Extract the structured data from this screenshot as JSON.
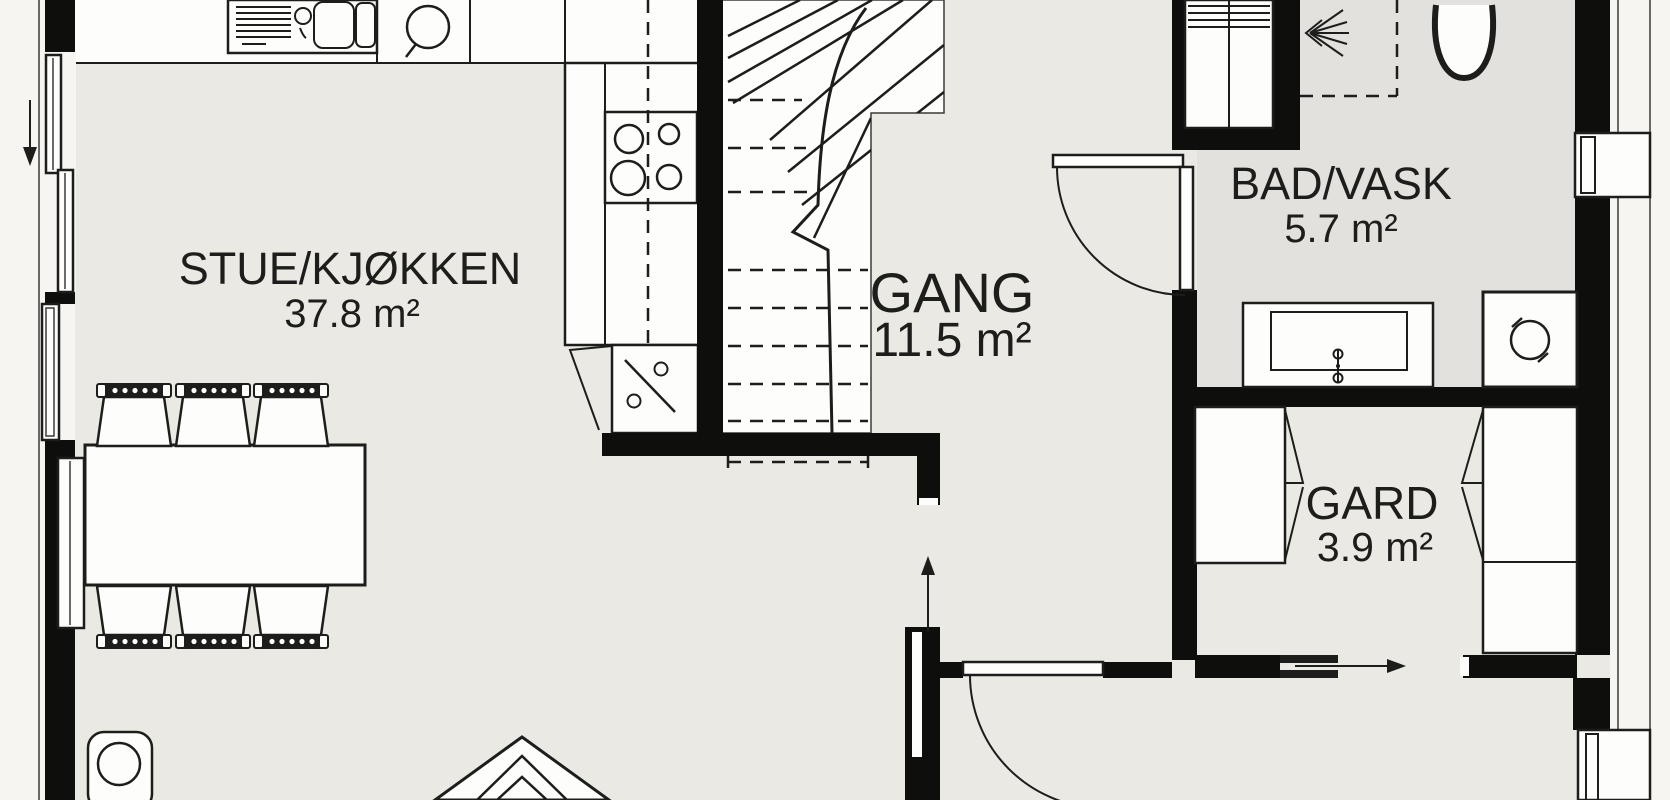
{
  "rooms": {
    "stue": {
      "name": "STUE/KJØKKEN",
      "area": "37.8 m²"
    },
    "gang": {
      "name": "GANG",
      "area": "11.5 m²"
    },
    "bad": {
      "name": "BAD/VASK",
      "area": "5.7 m²"
    },
    "gard": {
      "name": "GARD",
      "area": "3.9 m²"
    }
  },
  "colors": {
    "wall": "#0e0e0c",
    "floor": "#eae9e4",
    "floor_bad": "#e2e1dd",
    "outside": "#f6f5f1",
    "fixture_fill": "#fdfdfb",
    "line": "#1d1d1b"
  },
  "fixtures": [
    "kitchen-sink-icon",
    "water-heater-icon",
    "cooktop-icon",
    "corner-cabinet-icon",
    "staircase-icon",
    "closet-icon",
    "shower-icon",
    "toilet-icon",
    "vanity-sink-icon",
    "washing-machine-icon",
    "wardrobe-icon",
    "dining-table-icon",
    "chair-icon",
    "wood-stove-icon",
    "armchair-icon",
    "window-icon",
    "door-icon",
    "direction-arrow-icon"
  ]
}
